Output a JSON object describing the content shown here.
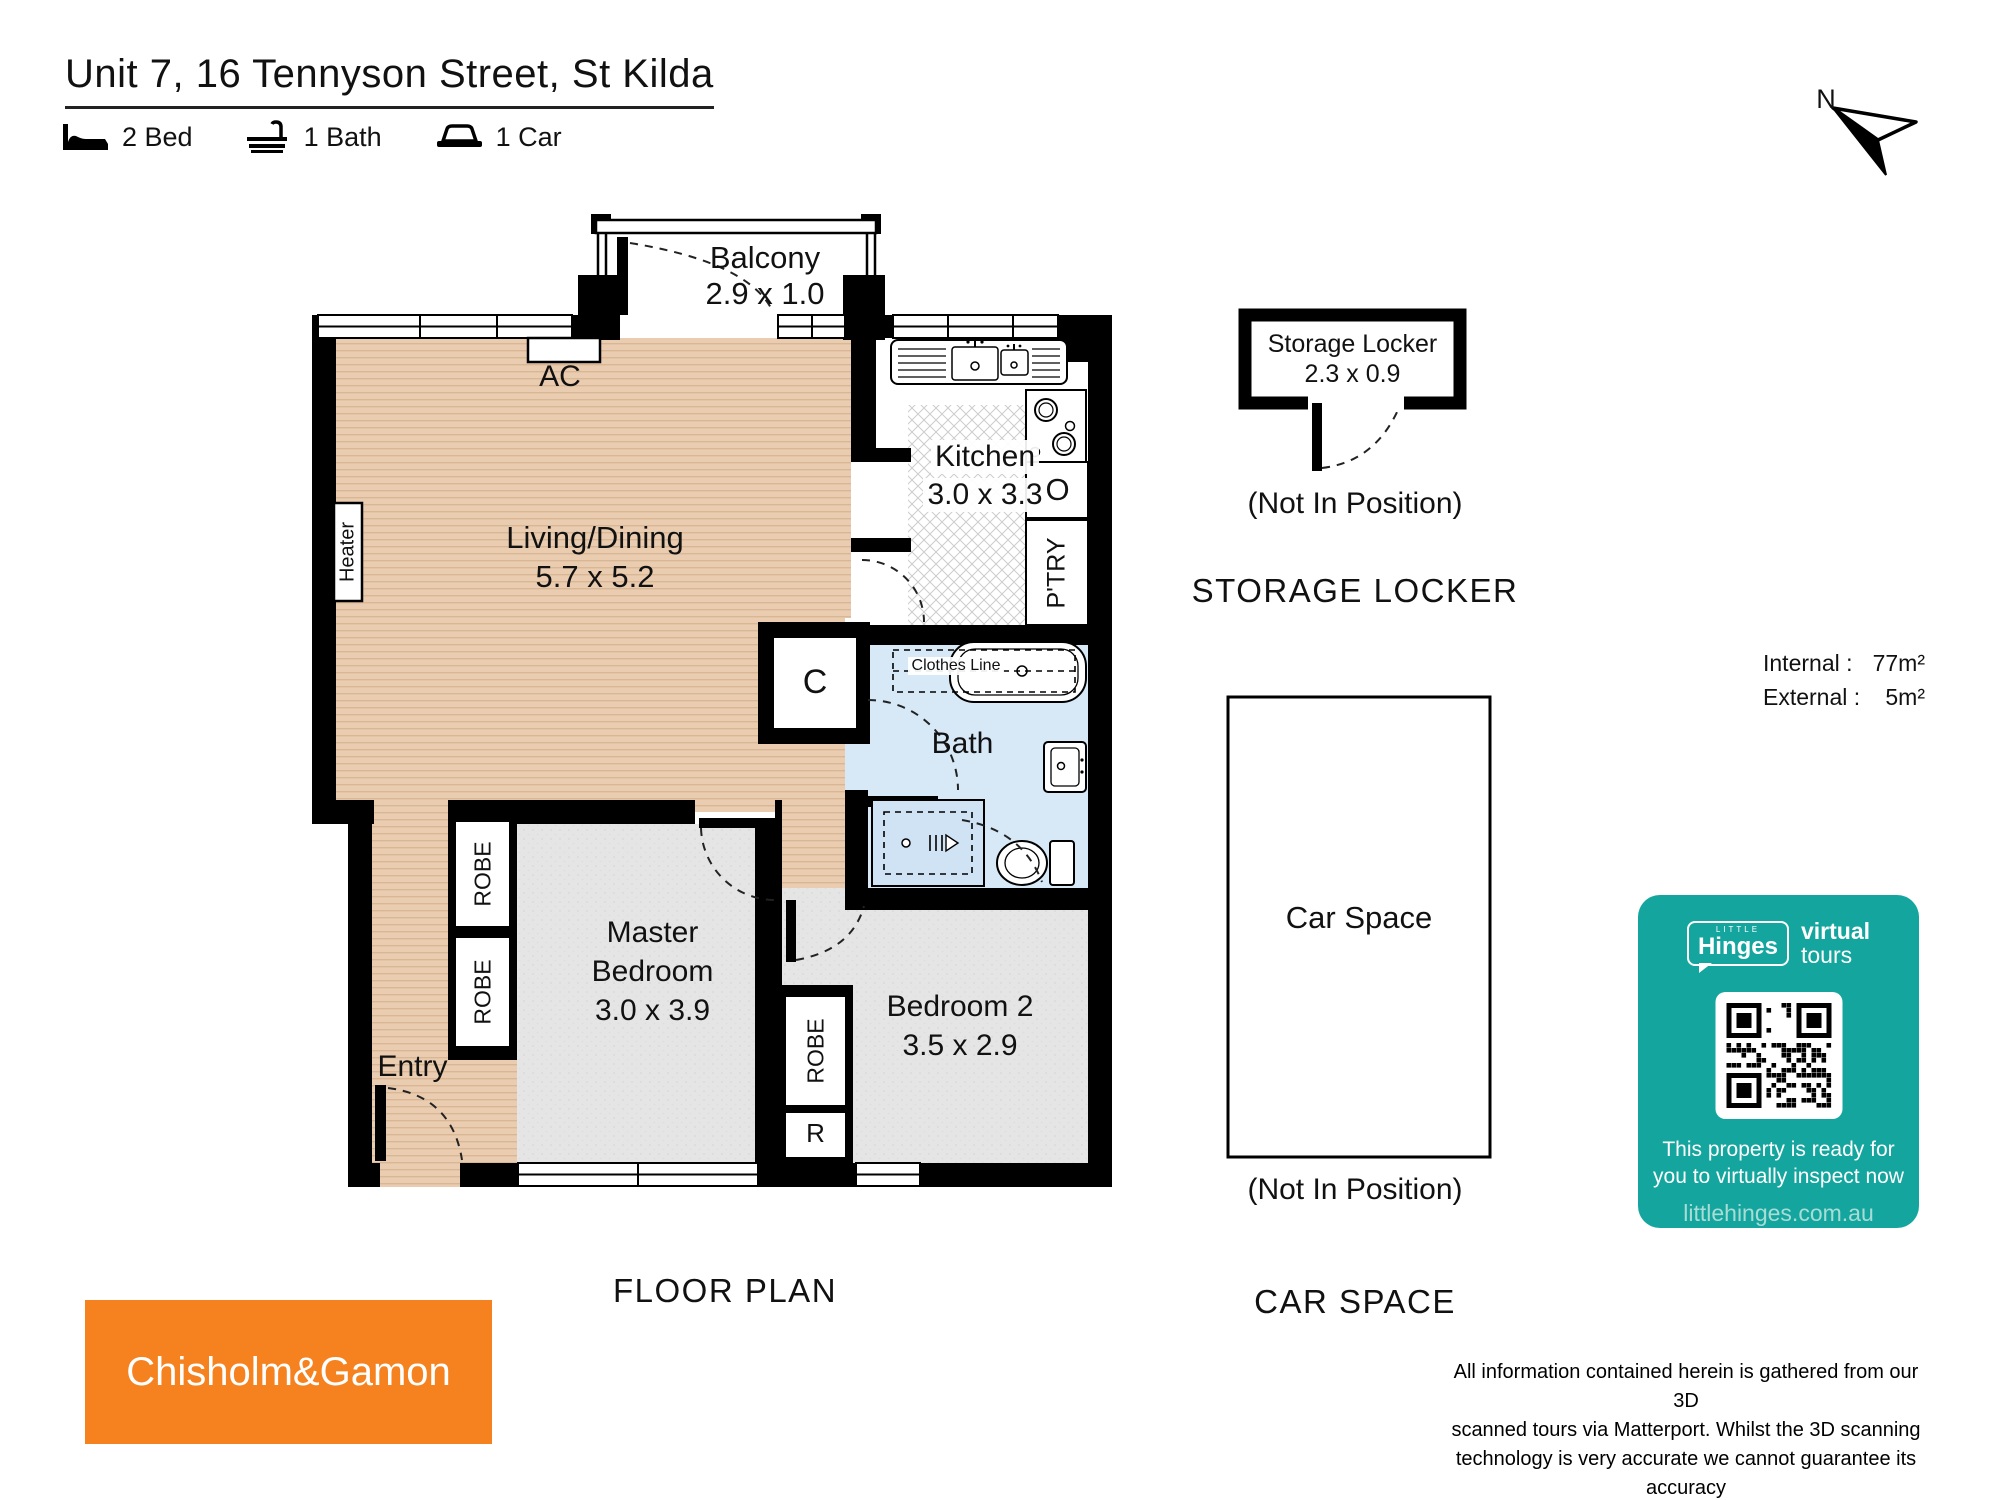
{
  "header": {
    "title": "Unit 7, 16 Tennyson Street, St Kilda",
    "features": [
      {
        "icon": "bed-icon",
        "label": "2 Bed"
      },
      {
        "icon": "bath-icon",
        "label": "1 Bath"
      },
      {
        "icon": "car-icon",
        "label": "1 Car"
      }
    ],
    "compass_label": "N"
  },
  "floor_plan": {
    "heading": "FLOOR PLAN",
    "rooms": {
      "balcony": {
        "name": "Balcony",
        "dims": "2.9 x 1.0"
      },
      "living": {
        "name": "Living/Dining",
        "dims": "5.7 x 5.2"
      },
      "kitchen": {
        "name": "Kitchen",
        "dims": "3.0 x 3.3"
      },
      "bath": {
        "name": "Bath"
      },
      "master": {
        "name_line1": "Master",
        "name_line2": "Bedroom",
        "dims": "3.0 x 3.9"
      },
      "bedroom2": {
        "name": "Bedroom 2",
        "dims": "3.5 x 2.9"
      },
      "entry": {
        "name": "Entry"
      }
    },
    "labels": {
      "ac": "AC",
      "heater": "Heater",
      "closet": "C",
      "clothes_line": "Clothes Line",
      "robe": "ROBE",
      "robe_short": "R",
      "pantry": "P'TRY",
      "oven": "O"
    }
  },
  "storage_locker": {
    "heading": "STORAGE LOCKER",
    "name": "Storage Locker",
    "dims": "2.3 x 0.9",
    "note": "(Not In Position)"
  },
  "car_space": {
    "heading": "CAR SPACE",
    "name": "Car Space",
    "note": "(Not In Position)"
  },
  "areas": {
    "rows": [
      {
        "label": "Internal :",
        "value": "77m²"
      },
      {
        "label": "External :",
        "value": "5m²"
      }
    ]
  },
  "virtual_tour_card": {
    "brand_little": "LITTLE",
    "brand_name": "Hinges",
    "product_line1": "virtual",
    "product_line2": "tours",
    "message_line1": "This property is ready for",
    "message_line2": "you to virtually inspect now",
    "website": "littlehinges.com.au",
    "bg_color": "#14a69e"
  },
  "agency": {
    "name": "Chisholm&Gamon",
    "bg_color": "#f5821e"
  },
  "disclaimer": {
    "lines": [
      "All information contained herein is gathered from our 3D",
      "scanned tours via Matterport. Whilst the 3D scanning",
      "technology is very accurate we cannot guarantee its accuracy",
      "and interested parties should rely on their own enquiries."
    ]
  }
}
